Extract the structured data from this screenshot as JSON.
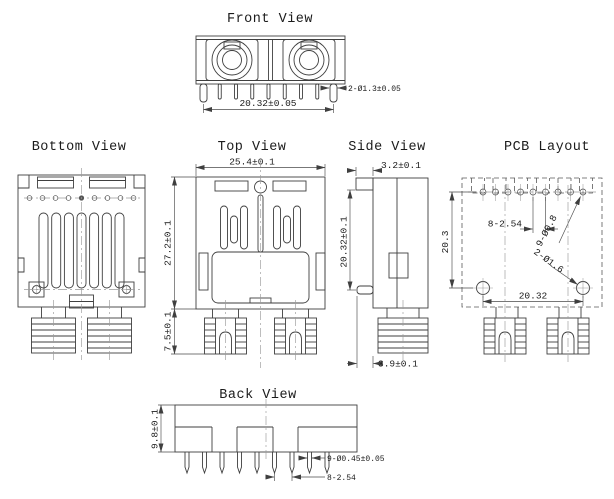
{
  "meta": {
    "bg_color": "#ffffff",
    "line_color": "#3f3f3f",
    "centerline_color": "#9a9a9a"
  },
  "views": {
    "front": {
      "title": "Front View",
      "dim_span": "20.32±0.05",
      "dim_mount_pins": "2-Ø1.3±0.05"
    },
    "bottom": {
      "title": "Bottom View"
    },
    "top": {
      "title": "Top View",
      "dim_width": "25.4±0.1",
      "dim_height": "27.2±0.1",
      "dim_boss": "7.5±0.1"
    },
    "side": {
      "title": "Side View",
      "dim_tab": "3.2±0.1",
      "dim_height": "20.32±0.1",
      "dim_offset": "3.9±0.1"
    },
    "pcb": {
      "title": "PCB Layout",
      "dim_rows": "20.3",
      "dim_pitch": "8-2.54",
      "dim_signal_holes": "9-Ø0.8",
      "dim_mount_holes": "2-Ø1.6",
      "dim_span": "20.32"
    },
    "back": {
      "title": "Back View",
      "dim_height": "9.8±0.1",
      "dim_pin_dia": "9-Ø0.45±0.05",
      "dim_pitch": "8-2.54"
    }
  }
}
